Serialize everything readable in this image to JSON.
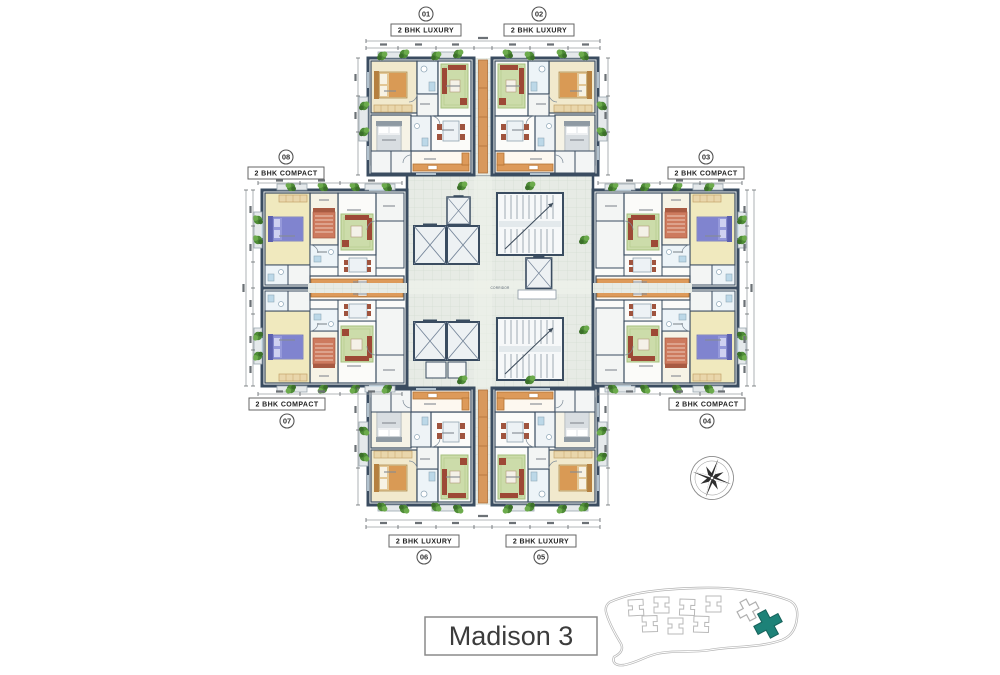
{
  "title": {
    "text": "Madison 3"
  },
  "plan": {
    "name": "Madison 3 typical floor plan",
    "units": [
      {
        "num": "01",
        "type": "2 BHK LUXURY",
        "location": "top-left"
      },
      {
        "num": "02",
        "type": "2 BHK LUXURY",
        "location": "top-right"
      },
      {
        "num": "03",
        "type": "2 BHK COMPACT",
        "location": "right-upper"
      },
      {
        "num": "04",
        "type": "2 BHK COMPACT",
        "location": "right-lower"
      },
      {
        "num": "05",
        "type": "2 BHK LUXURY",
        "location": "bottom-right"
      },
      {
        "num": "06",
        "type": "2 BHK LUXURY",
        "location": "bottom-left"
      },
      {
        "num": "07",
        "type": "2 BHK COMPACT",
        "location": "left-lower"
      },
      {
        "num": "08",
        "type": "2 BHK COMPACT",
        "location": "left-upper"
      }
    ],
    "corridor_label": "CORRIDOR"
  },
  "colors": {
    "wall": "#3a4c60",
    "floor_cream": "#f1e9cd",
    "floor_yellow": "#f0e9be",
    "rug_green": "#ccdcaa",
    "sofa_red": "#9d4936",
    "bed_purple": "#8084cf",
    "wood_orange": "#dd9a5a",
    "plant_green": "#4f8c37",
    "bath_blue": "#bcd8e8",
    "corridor_tile": "#e7ebe5",
    "site_highlight": "#1d8278"
  },
  "icons": {
    "compass": "compass-rose",
    "site_key": "site-location-key"
  }
}
